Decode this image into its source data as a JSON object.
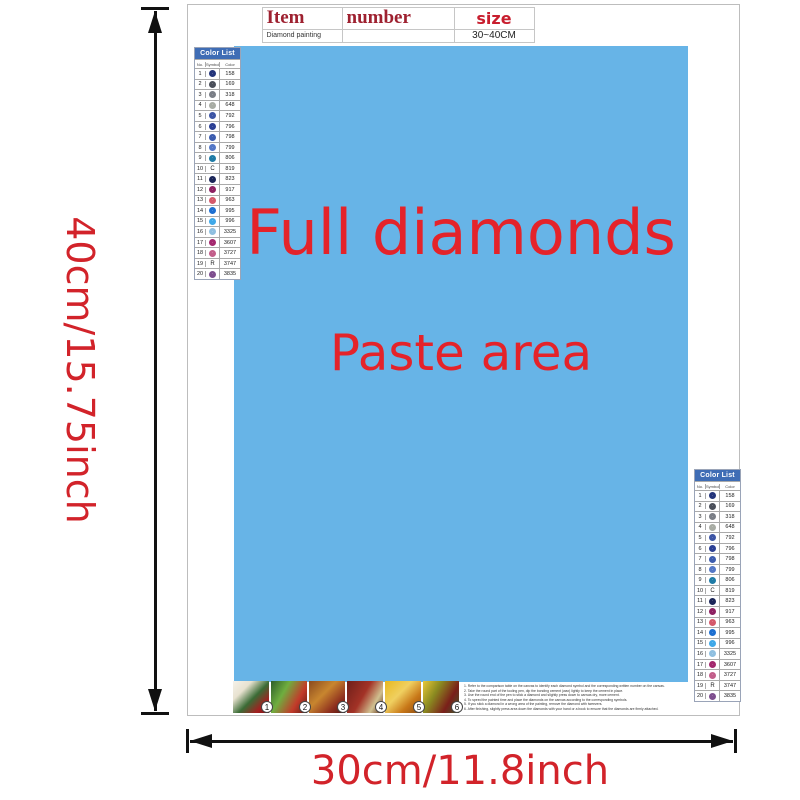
{
  "item_table": {
    "headers": [
      "Item",
      "number",
      "size"
    ],
    "row": {
      "product": "Diamond painting",
      "number": "",
      "size": "30~40CM"
    }
  },
  "paste_area": {
    "line1": "Full diamonds",
    "line2": "Paste area",
    "bg_color": "#67b4e7",
    "text_color": "#e4232a"
  },
  "dimensions": {
    "height_label": "40cm/15.75inch",
    "width_label": "30cm/11.8inch",
    "label_color": "#d2232a"
  },
  "color_list": {
    "title": "Color List",
    "columns": [
      "No.",
      "Symbol",
      "Color"
    ],
    "header_bg": "#3f6db5",
    "rows": [
      {
        "no": "1",
        "code": "158",
        "sym_type": "circle",
        "color": "#24357c"
      },
      {
        "no": "2",
        "code": "169",
        "sym_type": "circle",
        "color": "#4a4e59"
      },
      {
        "no": "3",
        "code": "318",
        "sym_type": "circle",
        "color": "#7a7e86"
      },
      {
        "no": "4",
        "code": "648",
        "sym_type": "circle",
        "color": "#a8aca4"
      },
      {
        "no": "5",
        "code": "792",
        "sym_type": "circle",
        "color": "#3d55a5"
      },
      {
        "no": "6",
        "code": "796",
        "sym_type": "circle",
        "color": "#2b3f94"
      },
      {
        "no": "7",
        "code": "798",
        "sym_type": "circle",
        "color": "#3c5cae"
      },
      {
        "no": "8",
        "code": "799",
        "sym_type": "circle",
        "color": "#5377c6"
      },
      {
        "no": "9",
        "code": "806",
        "sym_type": "circle",
        "color": "#1e7ba6"
      },
      {
        "no": "10",
        "code": "819",
        "sym_type": "letter",
        "letter": "C",
        "color": "#222222"
      },
      {
        "no": "11",
        "code": "823",
        "sym_type": "circle",
        "color": "#1a2558"
      },
      {
        "no": "12",
        "code": "917",
        "sym_type": "circle",
        "color": "#8e2162"
      },
      {
        "no": "13",
        "code": "963",
        "sym_type": "circle",
        "color": "#d4596b"
      },
      {
        "no": "14",
        "code": "995",
        "sym_type": "circle",
        "color": "#1d6fd1"
      },
      {
        "no": "15",
        "code": "996",
        "sym_type": "circle",
        "color": "#3fa8e8"
      },
      {
        "no": "16",
        "code": "3325",
        "sym_type": "circle",
        "color": "#8fbfe0"
      },
      {
        "no": "17",
        "code": "3607",
        "sym_type": "circle",
        "color": "#a3286e"
      },
      {
        "no": "18",
        "code": "3727",
        "sym_type": "circle",
        "color": "#c25e8a"
      },
      {
        "no": "19",
        "code": "3747",
        "sym_type": "letter",
        "letter": "R",
        "color": "#222222"
      },
      {
        "no": "20",
        "code": "3835",
        "sym_type": "circle",
        "color": "#7e4e8e"
      }
    ]
  },
  "steps": {
    "numbers": [
      "1",
      "2",
      "3",
      "4",
      "5",
      "6"
    ]
  },
  "instructions": {
    "lines": [
      "1. Refer to the comparison table on the canvas to identify each diamond symbol and the corresponding written number on the canvas.",
      "2. Take the round part of the tooling pen, dip the bonding cement (wax) lightly to keep the cement in place.",
      "3. Use the round end of the pen to stick a diamond and slightly press down to canvas dry, more cement.",
      "4. To speed the painted time and place the diamonds on the canvas according to the corresponding symbols.",
      "5. If you stick a diamond in a wrong area of the painting, remove the diamond with tweezers.",
      "6. After finishing, slightly press area down the diamonds with your hand or a book to ensure that the diamonds are firmly attached."
    ]
  }
}
